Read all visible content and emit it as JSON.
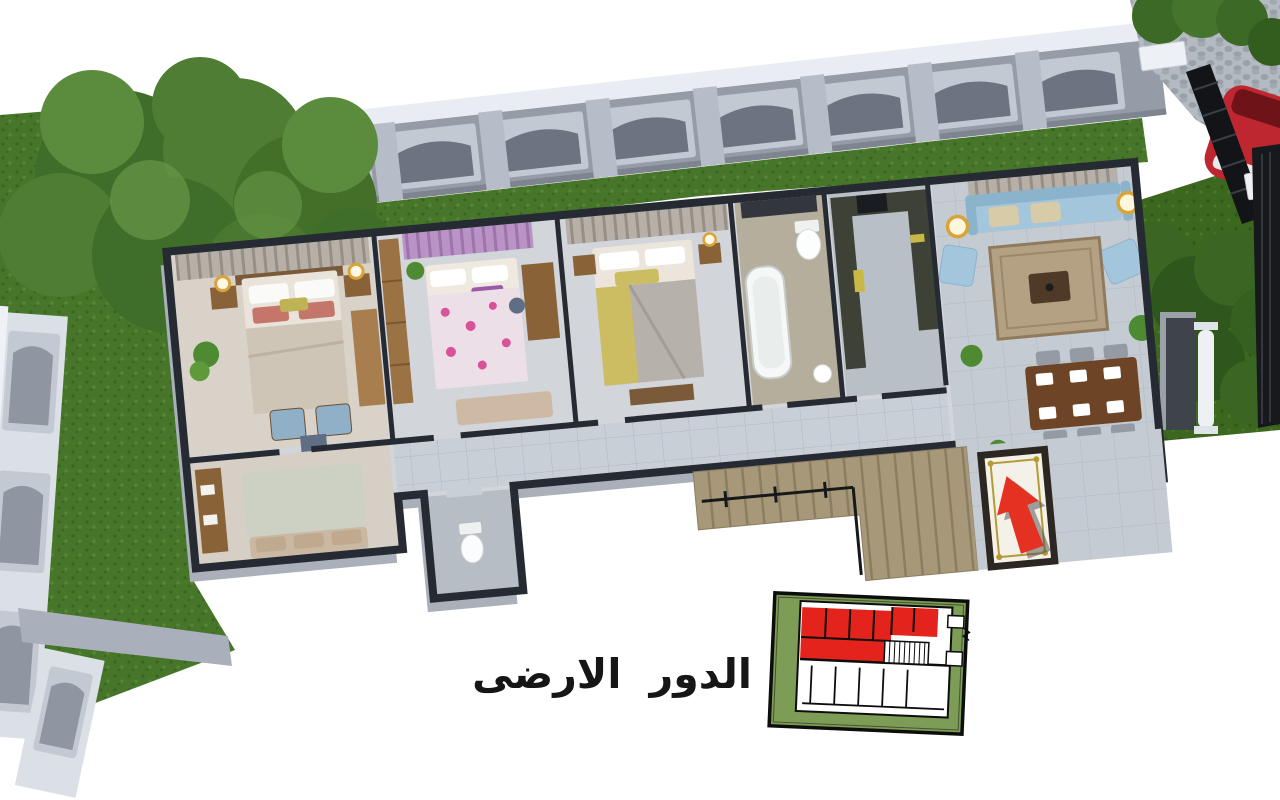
{
  "title": {
    "text": "الدور الارضى"
  },
  "scene": {
    "kind": "3d-rendered-ground-floor-plan",
    "rooms": [
      "master-bedroom",
      "kids-bedroom",
      "bedroom-3",
      "bathroom",
      "kitchen",
      "living-dining-room",
      "corridor",
      "sitting-room",
      "wc",
      "entrance-terrace"
    ],
    "outdoor": [
      "garden-grass",
      "boundary-fence",
      "tree",
      "driveway-cobblestone",
      "entry-gate",
      "parked-car",
      "stairs",
      "entrance-carpet"
    ]
  },
  "key_plan": {
    "type": "building-key-plan-minimap",
    "highlighted_area": "red-unit-top-wing"
  },
  "colors": {
    "bg": "#ffffff",
    "title_ink": "#161616",
    "grass": "#47762a",
    "grass_dark": "#3c671f",
    "fence_gray": "#959ca8",
    "fence_light": "#c3c9d3",
    "fence_panel": "#6d7380",
    "fence_cap": "#e9edf3",
    "wall_cut": "#262a32",
    "floor": "#d2d5da",
    "corridor": "#c9cfd7",
    "terrace": "#a79879",
    "carpet": "#f4f1e8",
    "arrow_red": "#e53122",
    "kp_green": "#7d9c55",
    "kp_red": "#e3231c",
    "ink": "#0d0d0d",
    "sofa_blue": "#a3c6dc",
    "rug_tan": "#b4a184",
    "wood": "#8a6238",
    "wood_dark": "#6e4427",
    "curtain_gray": "#b6b0a8",
    "curtain_lilac": "#b992c6",
    "marble_dark": "#3e4136",
    "plant_green": "#4e8a32",
    "gold": "#d9a437"
  }
}
